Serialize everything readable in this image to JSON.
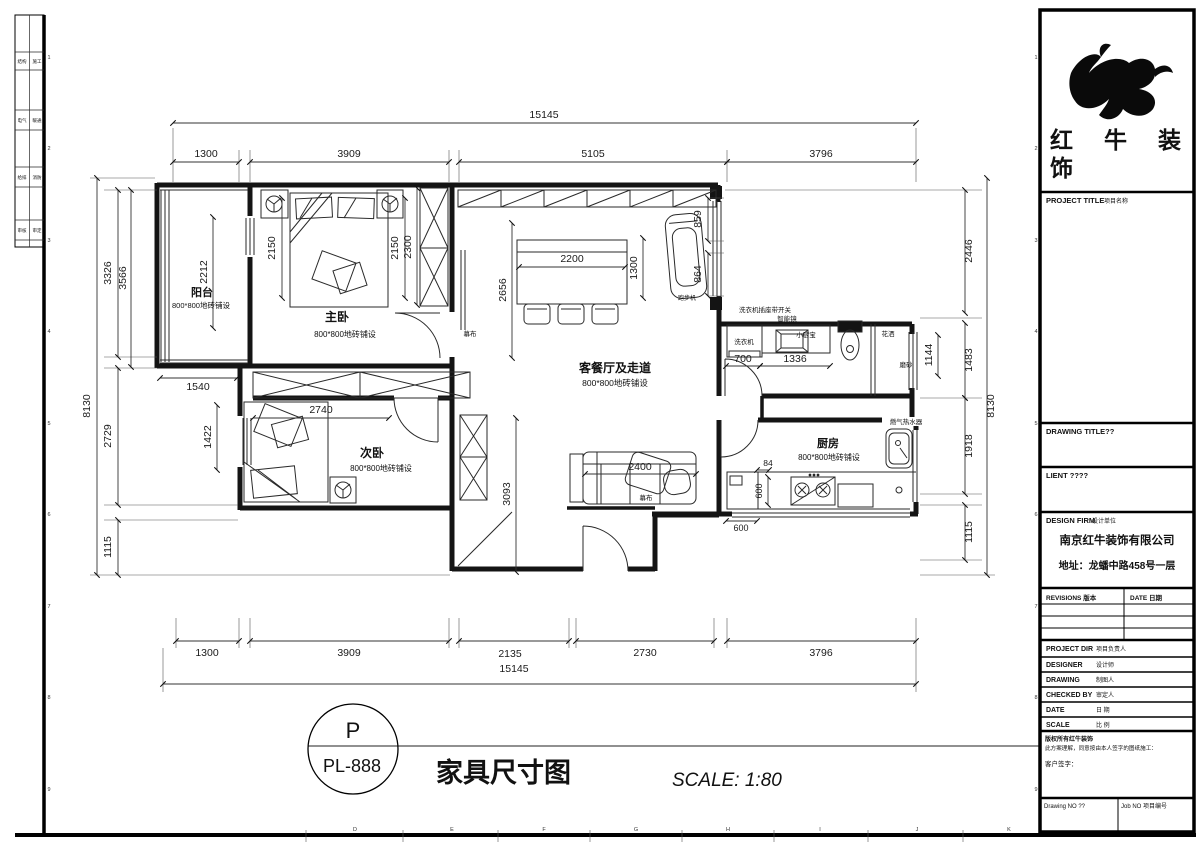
{
  "sheet": {
    "circle_ref": {
      "zone": "P",
      "number": "PL-888"
    },
    "title": "家具尺寸图",
    "scale_label": "SCALE: 1:80",
    "grid_letters": [
      "D",
      "E",
      "F",
      "G",
      "H",
      "I",
      "J",
      "K"
    ],
    "grid_numbers": [
      "1",
      "2",
      "3",
      "4",
      "5",
      "6",
      "7",
      "8",
      "9"
    ],
    "stamps": [
      [
        "结构",
        "施工"
      ],
      [
        "电气",
        "暖通"
      ],
      [
        "给排",
        "消防"
      ],
      [
        "审核",
        "审定"
      ]
    ]
  },
  "plan": {
    "rooms": {
      "balcony": {
        "name": "阳台",
        "tile": "800*800地砖铺设"
      },
      "master": {
        "name": "主卧",
        "tile": "800*800地砖铺设"
      },
      "second": {
        "name": "次卧",
        "tile": "800*800地砖铺设"
      },
      "living": {
        "name": "客餐厅及走道",
        "tile": "800*800地砖铺设"
      },
      "kitchen": {
        "name": "厨房",
        "tile": "800*800地砖铺设"
      }
    },
    "labels": {
      "washer_switch": "洗衣机插座带开关",
      "smart_mirror": "智能镜",
      "washer": "洗衣机",
      "mini_heater": "小厨宝",
      "shower": "花洒",
      "frosted": "磨砂",
      "gas_heater": "燃气热水器",
      "treadmill": "跑步机",
      "screen_living": "幕布",
      "screen_sofa": "幕布"
    },
    "dims": {
      "top": [
        "15145",
        "1300",
        "3909",
        "5105",
        "3796"
      ],
      "bottom": [
        "1300",
        "3909",
        "2135",
        "2730",
        "3796",
        "15145"
      ],
      "left": [
        "3326",
        "3566",
        "8130",
        "2729",
        "1115"
      ],
      "right": [
        "2446",
        "1483",
        "8130",
        "1918",
        "1115"
      ],
      "balcony_h": "2212",
      "balcony_w": "1540",
      "master_l": "2150",
      "master_r": "2150",
      "master_r2": "2300",
      "second_h": "1422",
      "second_w": "2740",
      "living_l": "2656",
      "table_w": "2200",
      "table_r": "1300",
      "win_a": "859",
      "win_b": "864",
      "bath_a": "700",
      "bath_b": "1336",
      "bath_r": "1144",
      "kit_a": "84",
      "kit_b": "600",
      "kit_c": "600",
      "sofa_w": "2400",
      "hall_h": "3093"
    }
  },
  "titleblock": {
    "brand_top": "红　牛　装",
    "brand_bottom": "饰",
    "project_title": "PROJECT TITLE",
    "project_title_cn": "项目名称",
    "drawing_title": "DRAWING TITLE??",
    "client": "LIENT ????",
    "design_firm": "DESIGN FIRM",
    "design_firm_cn": "设计单位",
    "company": "南京红牛装饰有限公司",
    "address": "地址：龙蟠中路458号一层",
    "revisions": "REVISIONS 版本",
    "date_col": "DATE 日期",
    "meta": [
      {
        "en": "PROJECT DIR",
        "cn": "项目负责人"
      },
      {
        "en": "DESIGNER",
        "cn": "设计师"
      },
      {
        "en": "DRAWING",
        "cn": "制图人"
      },
      {
        "en": "CHECKED BY",
        "cn": "审定人"
      },
      {
        "en": "DATE",
        "cn": "日 期"
      },
      {
        "en": "SCALE",
        "cn": "比 例"
      }
    ],
    "copyright_1": "版权所有红牛装饰",
    "copyright_2": "此方案理解，同意按由本人签字的图纸施工：",
    "client_sign": "客户签字：",
    "drawing_no": "Drawing NO ??",
    "job_no": "Job NO 项目编号"
  }
}
